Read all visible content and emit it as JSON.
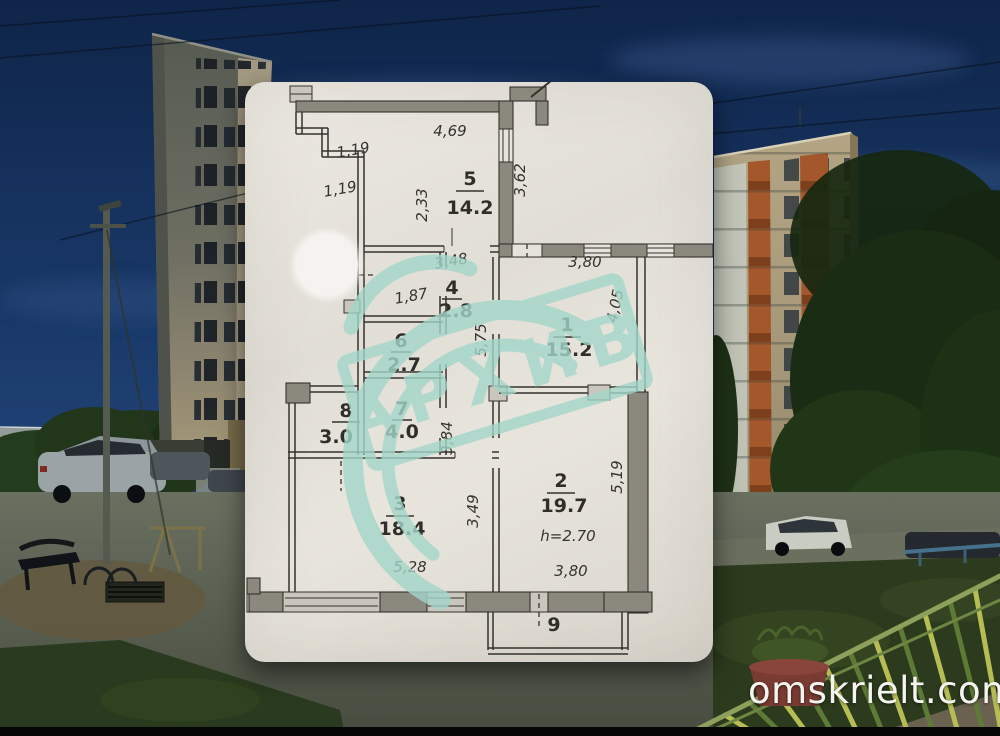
{
  "watermark": {
    "text": "omskrielt.com"
  },
  "stamp": {
    "text": "АРХИВ"
  },
  "colors": {
    "stamp_teal": "#a3d6ca",
    "paper": "#e6e3dc",
    "sky_top": "#0f2549",
    "plan_ink": "#34322d",
    "watermark_text": "#f4f4f0"
  },
  "plan": {
    "rooms": [
      {
        "id": "5",
        "area": "14.2"
      },
      {
        "id": "4",
        "area": "2.8"
      },
      {
        "id": "6",
        "area": "2.7"
      },
      {
        "id": "7",
        "area": "4.0"
      },
      {
        "id": "8",
        "area": "3.0"
      },
      {
        "id": "3",
        "area": "18.4"
      },
      {
        "id": "2",
        "area": "19.7",
        "ceiling_height": "h=2.70"
      },
      {
        "id": "1",
        "area": "15.2"
      },
      {
        "id": "9",
        "area": ""
      }
    ],
    "dimensions": {
      "room5_top": "4,69",
      "step_a": "1,19",
      "step_b": "1,19",
      "room5_left": "2,33",
      "room5_right": "3,62",
      "room4_top": "3,48",
      "room4_left": "1,87",
      "corridor_v": "5,75",
      "corridor_v2": "3,84",
      "room1_top": "3,80",
      "room1_right": "4,05",
      "room2_right": "5,19",
      "room3_right": "3,49",
      "room3_bottom": "5,28",
      "room2_bottom": "3,80"
    }
  }
}
